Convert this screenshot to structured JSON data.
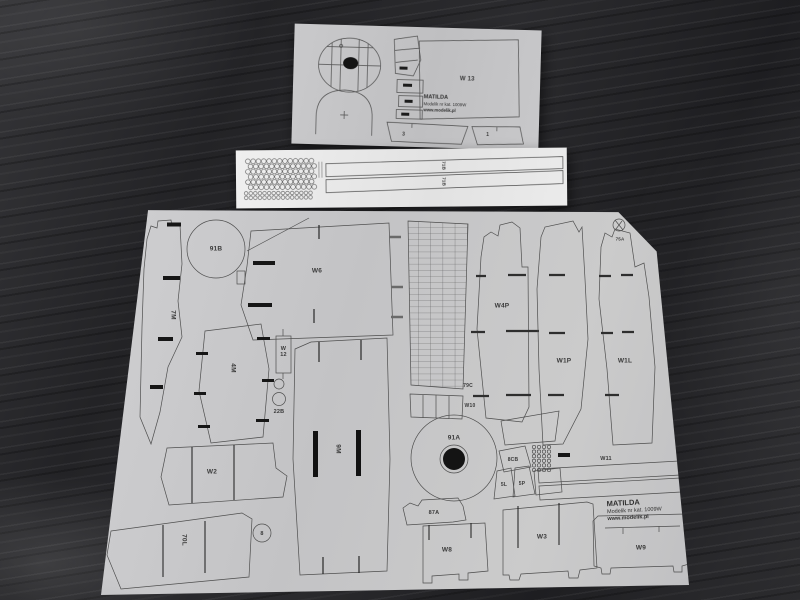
{
  "brand": {
    "title": "MATILDA",
    "catalog": "Modelik nr kat. 1009W",
    "website": "www.modelik.pl"
  },
  "palette": {
    "table_background": "#232326",
    "cardboard_sheet": "#c7c7c9",
    "strip_sheet": "#e9e9e9",
    "printed_ink": "#3a3a3a"
  },
  "sheets": {
    "small": {
      "parts": {
        "w13": "W 13",
        "p3": "3",
        "p1": "1"
      }
    },
    "strip": {
      "parts": {
        "top": "71B",
        "bottom": "71B"
      }
    },
    "main": {
      "parts": {
        "p91b": "91B",
        "p7m": "7M",
        "w6": "W6",
        "p4m": "4M",
        "w12": "W 12",
        "p22b": "22B",
        "p9m": "9M",
        "w2": "W2",
        "p70l": "70L",
        "p8": "8",
        "p79c": "79C",
        "w10": "W10",
        "w4p": "W4P",
        "w1p": "W1P",
        "w1l": "W1L",
        "p75a": "75A",
        "p91a": "91A",
        "p8cb": "8CB",
        "p5l": "5L",
        "p5p": "5P",
        "p87a": "87A",
        "w8": "W8",
        "w3": "W3",
        "w9": "W9",
        "w11": "W11"
      }
    }
  }
}
